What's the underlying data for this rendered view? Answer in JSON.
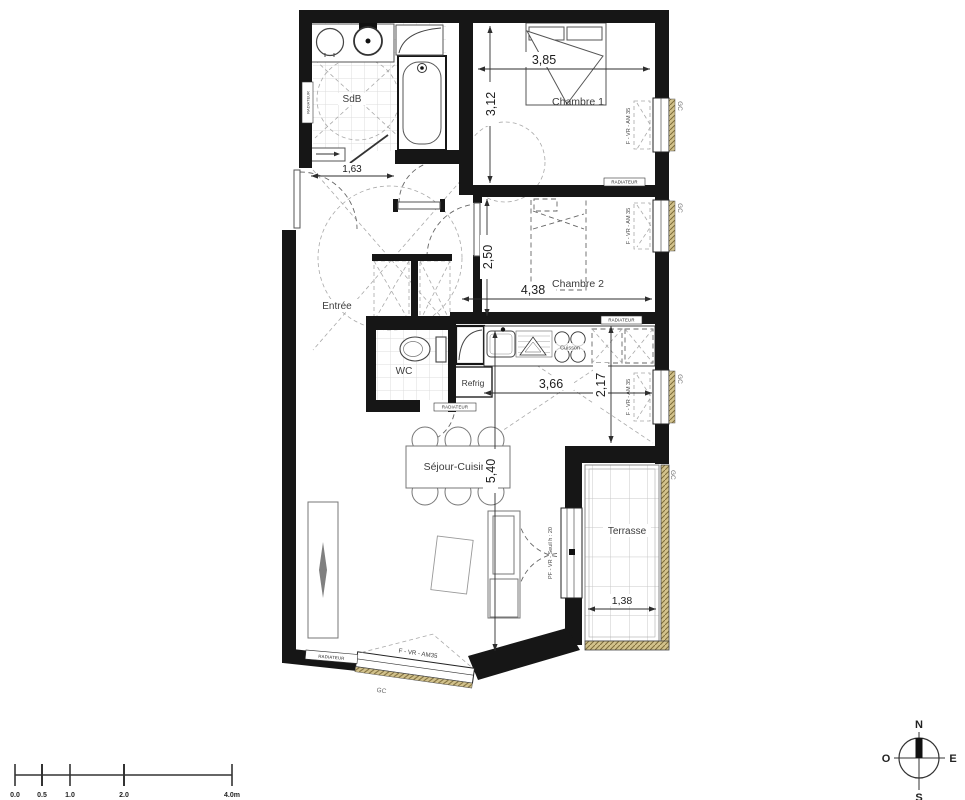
{
  "colors": {
    "wall": "#161616",
    "window_hatch": "#d2c28c",
    "window_hatch_line": "#7d6b3a"
  },
  "rooms": {
    "sdb": "SdB",
    "chambre1": "Chambre 1",
    "chambre2": "Chambre 2",
    "entree": "Entrée",
    "wc": "WC",
    "sejour": "Séjour-Cuisine",
    "terrasse": "Terrasse"
  },
  "appliances": {
    "refrig": "Refrig",
    "cuisson": "Cuisson"
  },
  "dims": {
    "sdb_w": "1,63",
    "ch1_w": "3,85",
    "ch1_h": "3,12",
    "ch2_h": "2,50",
    "ch2_w": "4,38",
    "cuisine_w": "3,66",
    "cuisine_h": "2,17",
    "sejour_h": "5,40",
    "terrasse_w": "1,38"
  },
  "labels": {
    "window": "F - VR - AM 35",
    "window_bottom": "F - VR - AM35",
    "door_terrasse": "PF - VR - Seuil h : 20",
    "gc": "GC",
    "radiateur": "RADIATEUR"
  },
  "scale_bar": {
    "t0": "0.0",
    "t05": "0.5",
    "t1": "1.0",
    "t2": "2.0",
    "t4": "4.0m"
  },
  "compass": {
    "n": "N",
    "s": "S",
    "o": "O",
    "e": "E"
  }
}
